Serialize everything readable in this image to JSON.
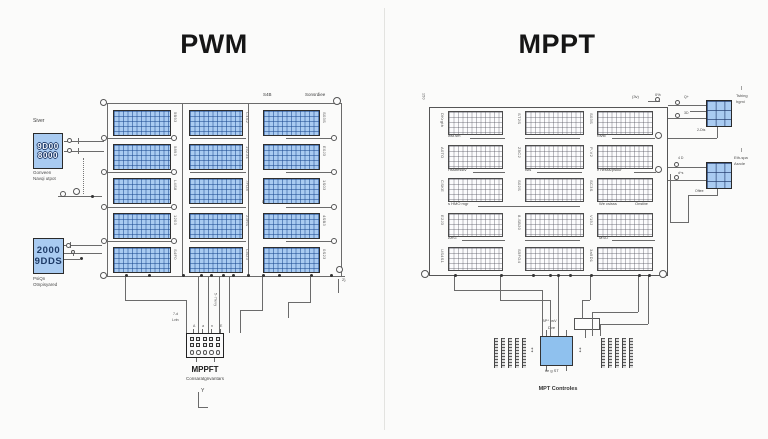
{
  "left": {
    "title": "PWM",
    "bus_label_1": "S4B",
    "bus_label_2": "Sonsrdiee",
    "inverter_label": "Siver",
    "inverter_line1": "9D00",
    "inverter_line2": "8000",
    "inverter_cap1": "Gonveen",
    "inverter_cap2": "Navqi utpot",
    "display_line1": "2000",
    "display_line2": "9DDS",
    "display_cap1": "PsiQn",
    "display_cap2": "Otnpisyared",
    "note_mid": "D. Tha vitta aqvw hyvaer",
    "note_low": "2. Sightsvar tsaee ptanmares",
    "wire_tag_1": "7-d",
    "wire_tag_2": "Lvtn",
    "wire_tag_3": "5-7levy",
    "pin_row": "A  a  n  E",
    "end_mark": "2}",
    "controller_title": "MPPFT",
    "controller_sub": "Consaratgnvantars",
    "bracket": "Y",
    "panel_labels": [
      "5B93",
      "C4S2",
      "S03S",
      "5893",
      "19Z34",
      "E0J3",
      "L4S8",
      "7FD8",
      "1S03",
      "1203",
      "23RS",
      "4SB3",
      "S4F0",
      "CB23",
      "0S23"
    ]
  },
  "right": {
    "title": "MPPT",
    "corner_tag": "150",
    "top_tag_1": "(3v)",
    "top_tag_2": "0%",
    "row_captions": [
      [
        "wst.sm",
        "",
        "rovst"
      ],
      [
        "Hsstfesstv",
        "tsts",
        "e nesss/pskur"
      ],
      [
        "s HMO mgr",
        "We csisss",
        "Onstbe"
      ],
      [
        "ARG",
        "",
        "MSO"
      ]
    ],
    "box1": {
      "i": "I",
      "l1": "Tshing",
      "l2": "hgmi",
      "note": "2-Dts",
      "m1": "Q+",
      "m2": "3D"
    },
    "box2": {
      "i": "I",
      "l1": "Eth-spa",
      "l2": "Asrcle",
      "note": "Oftee",
      "m1": "4 D",
      "m2": "d^s"
    },
    "controller": {
      "t1": "BP* twV",
      "t2": "Dve",
      "b": "tie g ST",
      "caption": "MPT Controles",
      "arrow": "↕"
    },
    "panel_labels": [
      "DKrgth",
      "ST2S",
      "S03S",
      "A0TO",
      "Z5C2",
      "P-V2",
      "CSKE",
      "S02S",
      "SC3S",
      "E2J3",
      "8-SB20",
      "V15J",
      "US4S1",
      "S5FG4",
      "3a5D1"
    ]
  },
  "colors": {
    "panel_blue": "#a9cbf1",
    "grid_blue": "#3d6db0",
    "controller_blue": "#8fc1ee",
    "wire_gray": "#6b6b6b"
  }
}
